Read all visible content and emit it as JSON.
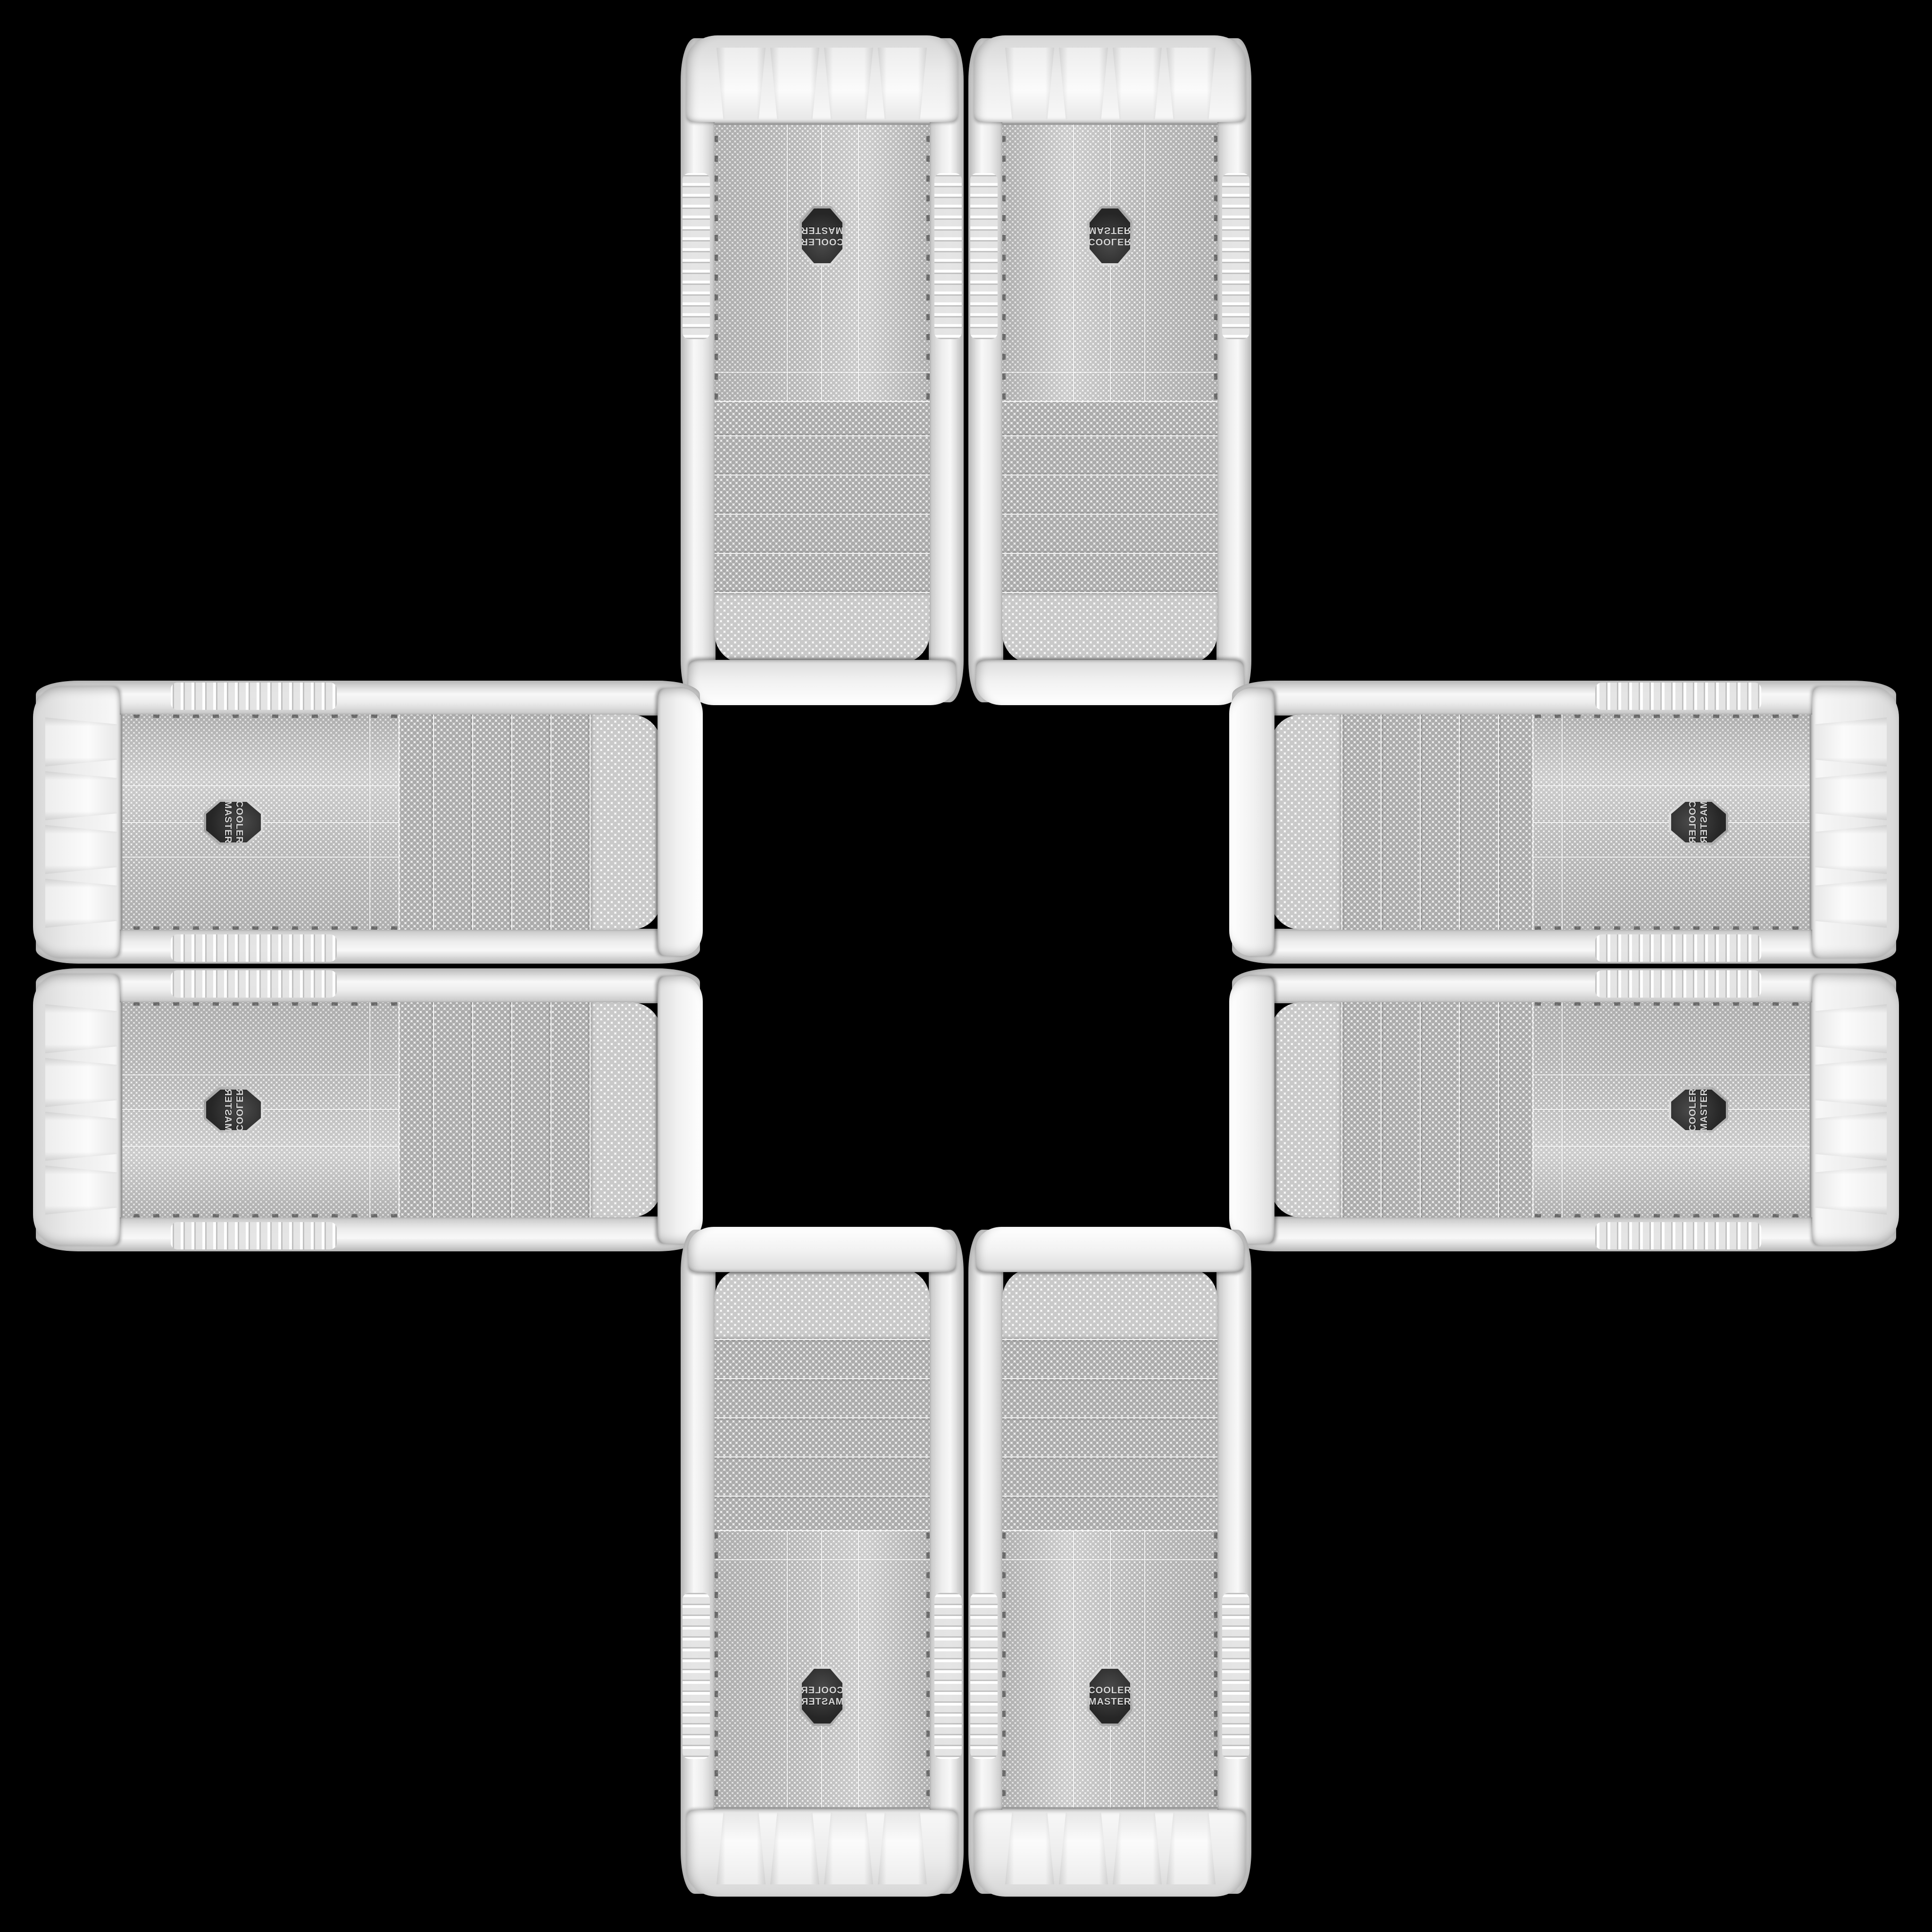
{
  "scene": {
    "description": "Eight identical white Cooler Master mesh-front mid-tower PC cases arranged in a plus / cross mandala on a solid black background; pairs are mirrored across the vertical and horizontal axes with an empty black center",
    "product": "Cooler Master white mesh-front PC tower case",
    "case_count": 8,
    "arrangement": "cross"
  },
  "badge": {
    "line1": "COOLER",
    "line2": "MASTER"
  },
  "colors": {
    "background": "#000000",
    "case_white": "#f2f2f2",
    "bezel_shadow": "#d6d6d6",
    "mesh_base": "#f0f0f0",
    "mesh_dot": "#b5b5b5",
    "chrome_trim": "#9a9a9a",
    "badge_background": "#2f2f2f",
    "badge_text": "#d6d6d6"
  },
  "cases": [
    {
      "position": "top-left",
      "orientation": "vertical, rotated 180°"
    },
    {
      "position": "top-right",
      "orientation": "vertical, flipped vertically"
    },
    {
      "position": "left-top",
      "orientation": "horizontal, top toward center"
    },
    {
      "position": "left-bottom",
      "orientation": "horizontal, mirrored"
    },
    {
      "position": "right-top",
      "orientation": "horizontal, top toward center"
    },
    {
      "position": "right-bottom",
      "orientation": "horizontal, mirrored"
    },
    {
      "position": "bottom-left",
      "orientation": "vertical, flipped horizontally"
    },
    {
      "position": "bottom-right",
      "orientation": "vertical, upright"
    }
  ]
}
